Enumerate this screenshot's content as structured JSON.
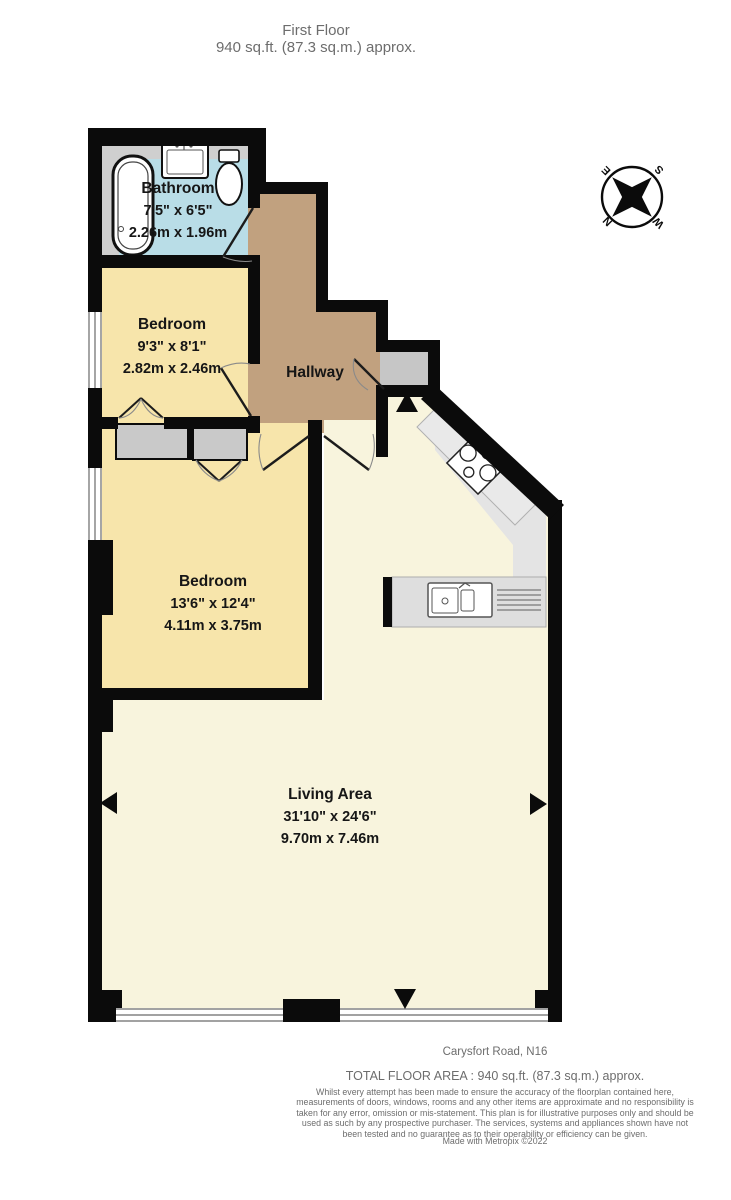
{
  "title": {
    "line1": "First Floor",
    "line2": "940 sq.ft. (87.3 sq.m.) approx."
  },
  "rooms": {
    "bathroom": {
      "name": "Bathroom",
      "imperial": "7'5\"  x 6'5\"",
      "metric": "2.26m  x 1.96m"
    },
    "bedroom1": {
      "name": "Bedroom",
      "imperial": "9'3\"  x 8'1\"",
      "metric": "2.82m  x 2.46m"
    },
    "hallway": {
      "name": "Hallway"
    },
    "bedroom2": {
      "name": "Bedroom",
      "imperial": "13'6\"  x 12'4\"",
      "metric": "4.11m  x 3.75m"
    },
    "living": {
      "name": "Living Area",
      "imperial": "31'10\"  x 24'6\"",
      "metric": "9.70m  x 7.46m"
    }
  },
  "compass": {
    "n": "N",
    "e": "E",
    "s": "S",
    "w": "W"
  },
  "footer": {
    "address": "Carysfort Road, N16",
    "total_area": "TOTAL FLOOR AREA : 940 sq.ft. (87.3 sq.m.) approx.",
    "disclaimer": "Whilst every attempt has been made to ensure the accuracy of the floorplan contained here, measurements of doors, windows, rooms and any other items are approximate and no responsibility is taken for any error, omission or mis-statement. This plan is for illustrative purposes only and should be used as such by any prospective purchaser. The services, systems and appliances shown have not been tested and no guarantee as to their operability or efficiency can be given.",
    "credit": "Made with Metropix ©2022"
  },
  "colors": {
    "wall": "#0b0b0b",
    "bathroom": "#b9dde7",
    "bedroom": "#f7e5ab",
    "hallway": "#c1a17f",
    "living": "#f8f4dd",
    "kitchen_floor": "#e4e4e4",
    "counter": "#dedede",
    "closet": "#c9c9c9",
    "label_text": "#161616",
    "muted_text": "#6d6d6d"
  }
}
